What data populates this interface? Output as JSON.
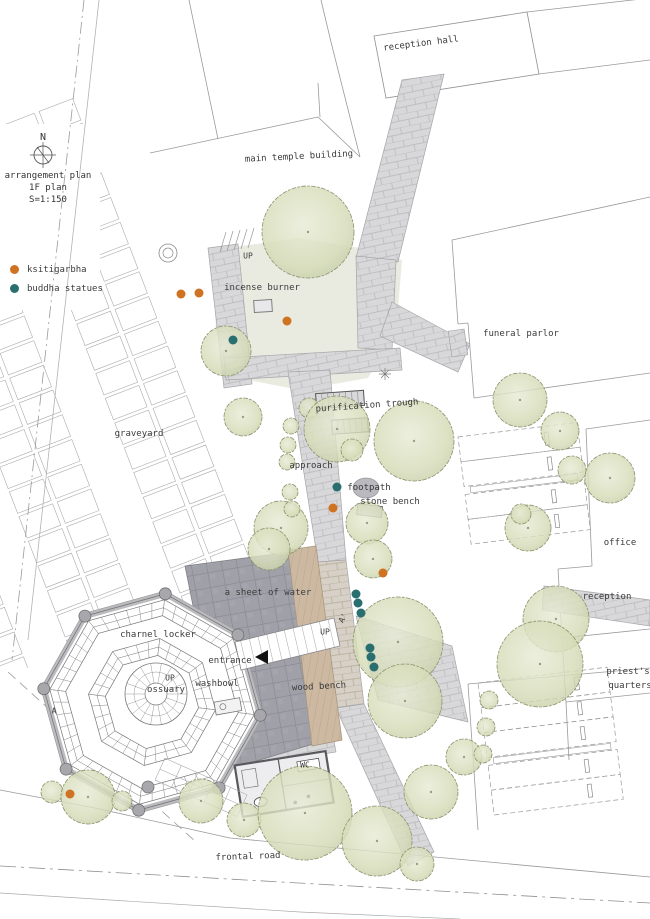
{
  "title_block": {
    "north_label": "N",
    "line1": "arrangement plan",
    "line2": "1F plan",
    "line3": "S=1:150"
  },
  "legend": {
    "items": [
      {
        "label": "ksitigarbha",
        "color": "#cf7222"
      },
      {
        "label": "buddha statues",
        "color": "#2a6f70"
      }
    ]
  },
  "labels": {
    "reception_hall": "reception hall",
    "main_temple_building": "main temple building",
    "incense_burner": "incense burner",
    "funeral_parlor": "funeral parlor",
    "purification_trough": "purification trough",
    "graveyard": "graveyard",
    "approach": "approach",
    "footpath": "footpath",
    "stone_bench": "stone bench",
    "office": "office",
    "reception": "reception",
    "sheet_of_water": "a sheet of water",
    "charnel_locker": "charnel locker",
    "entrance": "entrance",
    "washbowl": "washbowl",
    "ossuary": "ossuary",
    "wood_bench": "wood bench",
    "priests_line1": "priest's",
    "priests_line2": "quarters",
    "wc": "WC",
    "frontal_road": "frontal road",
    "up_plaza": "UP",
    "up_bridge": "UP",
    "up_ossuary": "UP",
    "section_a": "A",
    "section_a_prime": "A'"
  },
  "markers": {
    "ksitigarbha": [
      [
        181,
        294
      ],
      [
        199,
        293
      ],
      [
        287,
        321
      ],
      [
        333,
        508
      ],
      [
        383,
        573
      ],
      [
        70,
        794
      ]
    ],
    "buddha_statues": [
      [
        233,
        340
      ],
      [
        337,
        487
      ],
      [
        356,
        594
      ],
      [
        358,
        603
      ],
      [
        361,
        613
      ],
      [
        370,
        648
      ],
      [
        371,
        657
      ],
      [
        374,
        667
      ]
    ]
  },
  "trees": [
    [
      308,
      232,
      46
    ],
    [
      226,
      351,
      25
    ],
    [
      243,
      417,
      19
    ],
    [
      309,
      408,
      10
    ],
    [
      337,
      429,
      33
    ],
    [
      414,
      441,
      40
    ],
    [
      352,
      450,
      11
    ],
    [
      281,
      528,
      27
    ],
    [
      269,
      549,
      21
    ],
    [
      367,
      523,
      21
    ],
    [
      373,
      559,
      19
    ],
    [
      291,
      426,
      8
    ],
    [
      288,
      445,
      8
    ],
    [
      287,
      462,
      8
    ],
    [
      290,
      492,
      8
    ],
    [
      292,
      509,
      8
    ],
    [
      398,
      642,
      45
    ],
    [
      405,
      701,
      37
    ],
    [
      520,
      400,
      27
    ],
    [
      560,
      431,
      19
    ],
    [
      610,
      478,
      25
    ],
    [
      572,
      470,
      14
    ],
    [
      528,
      528,
      23
    ],
    [
      521,
      514,
      10
    ],
    [
      556,
      619,
      33
    ],
    [
      540,
      664,
      43
    ],
    [
      52,
      792,
      11
    ],
    [
      88,
      797,
      27
    ],
    [
      122,
      801,
      10
    ],
    [
      201,
      801,
      22
    ],
    [
      244,
      820,
      17
    ],
    [
      305,
      813,
      47
    ],
    [
      377,
      841,
      35
    ],
    [
      431,
      792,
      27
    ],
    [
      464,
      757,
      18
    ],
    [
      417,
      864,
      17
    ],
    [
      489,
      700,
      9
    ],
    [
      486,
      727,
      9
    ],
    [
      483,
      754,
      9
    ]
  ],
  "colors": {
    "ksitigarbha": "#cf7222",
    "buddha_statues": "#2a6f70",
    "paving": "#d8d8da",
    "paving_warm": "#d6d0c6",
    "water": "#a0a0a8",
    "wood": "#cdb9a2",
    "tree_fill": "#dce0c4",
    "tree_edge": "#89926c",
    "line": "#9a9a9e",
    "label_text": "#3b3b3b"
  }
}
